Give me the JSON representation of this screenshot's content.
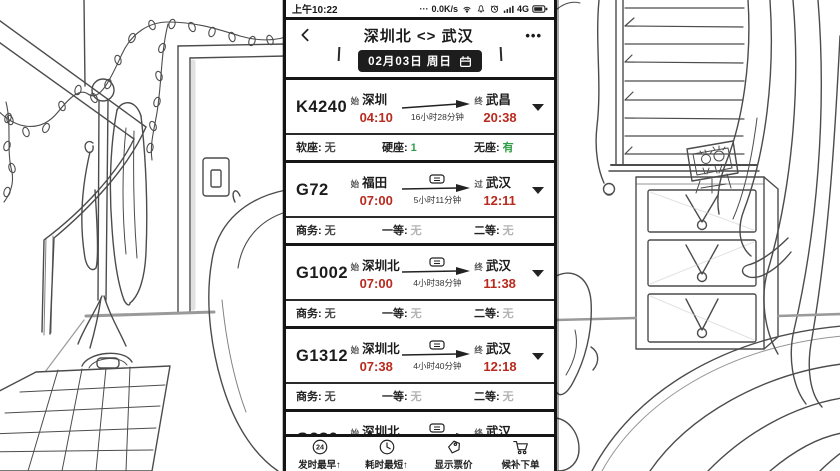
{
  "colors": {
    "ink": "#1b1b1b",
    "red": "#b92a1e",
    "green": "#2f9e44",
    "gray": "#b3b3b3"
  },
  "status_bar": {
    "time": "上午10:22",
    "dots": "···",
    "speed": "0.0K/s",
    "network": "4G"
  },
  "header": {
    "title": "深圳北 <> 武汉",
    "more": "•••"
  },
  "date_bar": {
    "label": "02月03日 周日"
  },
  "icons": {
    "sort24": "24"
  },
  "trains": [
    {
      "no": "K4240",
      "from_tag": "始",
      "from": "深圳",
      "depart": "04:10",
      "duration": "16小时28分钟",
      "to_tag": "终",
      "to": "武昌",
      "arrive": "20:38",
      "seats": [
        {
          "label": "软座:",
          "value": "无",
          "cls": "sv dark"
        },
        {
          "label": "硬座:",
          "value": "1",
          "cls": "sv green"
        },
        {
          "label": "无座:",
          "value": "有",
          "cls": "sv green"
        }
      ]
    },
    {
      "no": "G72",
      "from_tag": "始",
      "from": "福田",
      "depart": "07:00",
      "duration": "5小时11分钟",
      "to_tag": "过",
      "to": "武汉",
      "arrive": "12:11",
      "seats": [
        {
          "label": "商务:",
          "value": "无",
          "cls": "sv dark"
        },
        {
          "label": "一等:",
          "value": "无",
          "cls": "sv gray"
        },
        {
          "label": "二等:",
          "value": "无",
          "cls": "sv gray"
        }
      ]
    },
    {
      "no": "G1002",
      "from_tag": "始",
      "from": "深圳北",
      "depart": "07:00",
      "duration": "4小时38分钟",
      "to_tag": "终",
      "to": "武汉",
      "arrive": "11:38",
      "seats": [
        {
          "label": "商务:",
          "value": "无",
          "cls": "sv dark"
        },
        {
          "label": "一等:",
          "value": "无",
          "cls": "sv gray"
        },
        {
          "label": "二等:",
          "value": "无",
          "cls": "sv gray"
        }
      ]
    },
    {
      "no": "G1312",
      "from_tag": "始",
      "from": "深圳北",
      "depart": "07:38",
      "duration": "4小时40分钟",
      "to_tag": "终",
      "to": "武汉",
      "arrive": "12:18",
      "seats": [
        {
          "label": "商务:",
          "value": "无",
          "cls": "sv dark"
        },
        {
          "label": "一等:",
          "value": "无",
          "cls": "sv gray"
        },
        {
          "label": "二等:",
          "value": "无",
          "cls": "sv gray"
        }
      ]
    },
    {
      "no": "G280",
      "from_tag": "始",
      "from": "深圳北",
      "depart": "07:43",
      "duration": "4小时44分钟",
      "to_tag": "终",
      "to": "武汉",
      "arrive": "12:27",
      "seats": []
    }
  ],
  "toolbar": {
    "items": [
      {
        "label": "发时最早↑",
        "icon": "badge-24-icon"
      },
      {
        "label": "耗时最短↑",
        "icon": "clock-icon"
      },
      {
        "label": "显示票价",
        "icon": "price-tag-icon"
      },
      {
        "label": "候补下单",
        "icon": "cart-icon"
      }
    ]
  }
}
